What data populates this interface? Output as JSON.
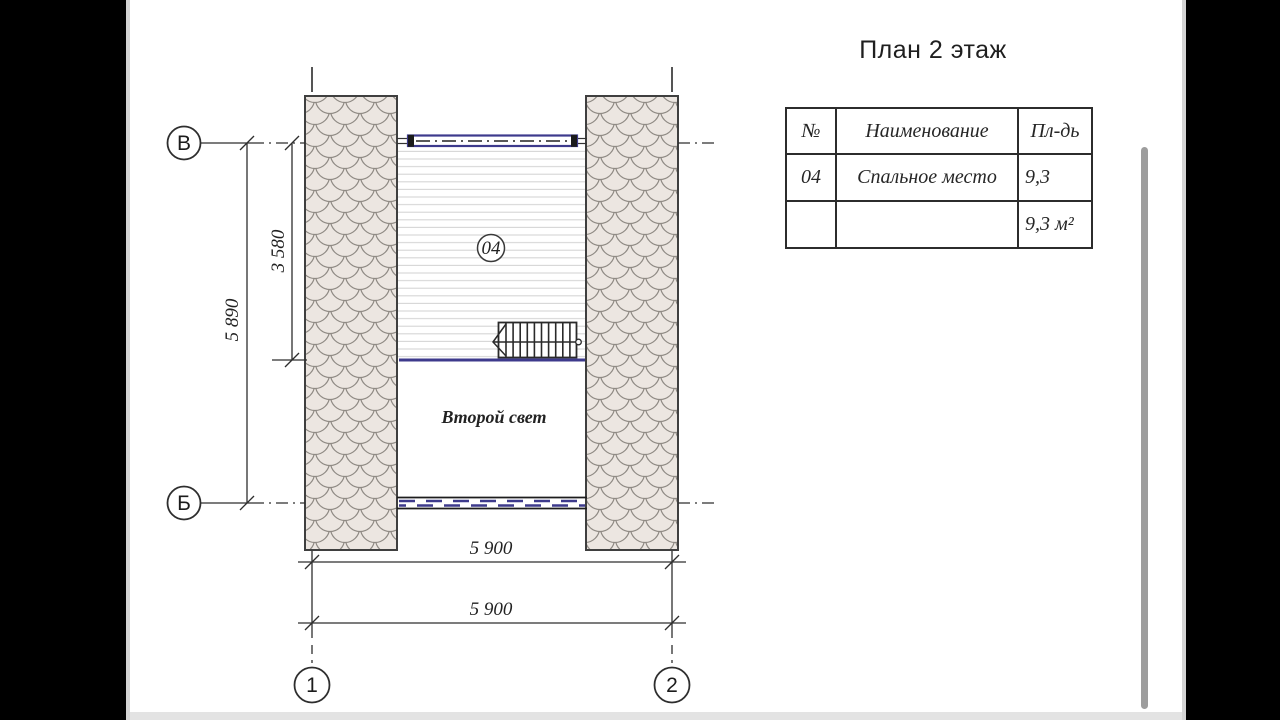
{
  "title": "План 2 этаж",
  "legend_table": {
    "headers": [
      "№",
      "Наименование",
      "Пл-дь"
    ],
    "rows": [
      {
        "num": "04",
        "name": "Спальное место",
        "area": "9,3"
      },
      {
        "num": "",
        "name": "",
        "area": "9,3 м²"
      }
    ]
  },
  "drawing": {
    "axis_v": "В",
    "axis_b": "Б",
    "axis_1": "1",
    "axis_2": "2",
    "dim_total_v": "5 890",
    "dim_upper_v": "3 580",
    "dim_h_inner": "5 900",
    "dim_h_outer": "5 900",
    "room_tag": "04",
    "second_light_label": "Второй свет"
  },
  "colors": {
    "window_accent": "#3d3a8c",
    "wall_fill": "#ece6e1",
    "wall_scale_line": "#8f8a84",
    "drawing_line": "#2e2e2e"
  }
}
